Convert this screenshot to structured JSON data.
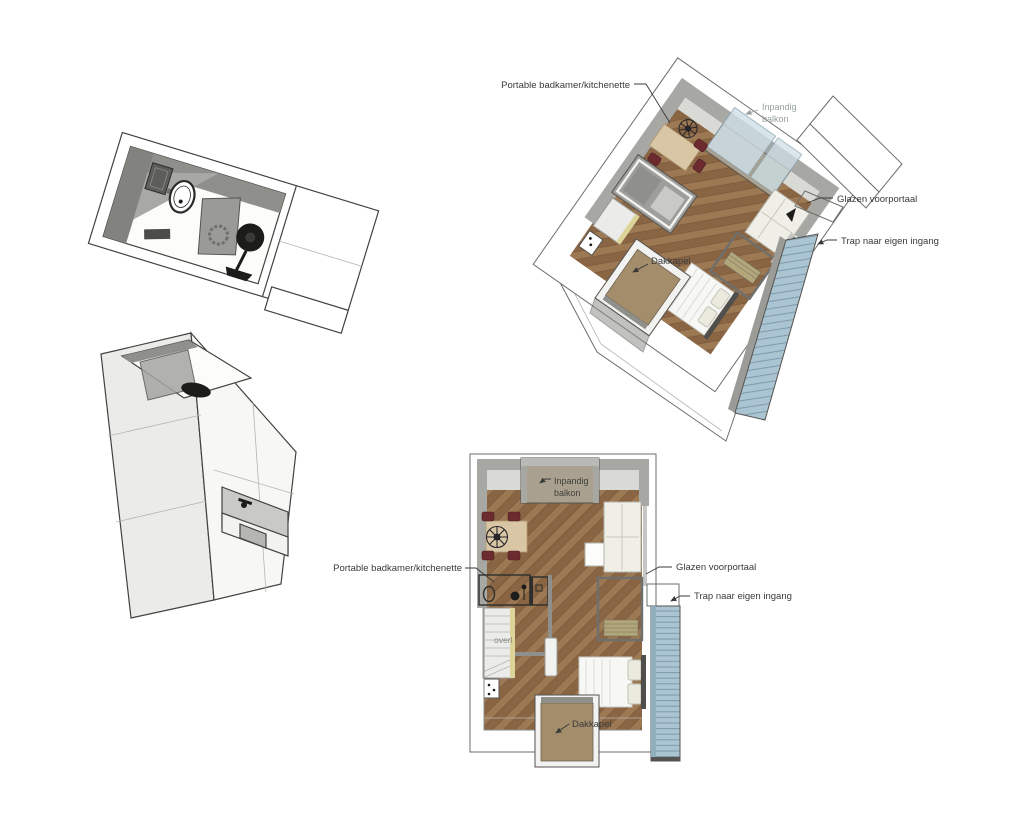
{
  "labels": {
    "axon": {
      "portable": "Portable badkamer/kitchenette",
      "inpandig": [
        "Inpandig",
        "balkon"
      ],
      "dakkapel": "Dakkapel",
      "glazen": "Glazen voorportaal",
      "trap": "Trap naar eigen ingang"
    },
    "top": {
      "inpandig": [
        "Inpandig",
        "balkon"
      ],
      "portable": "Portable badkamer/kitchenette",
      "glazen": "Glazen voorportaal",
      "trap": "Trap naar eigen ingang",
      "dakkapel": "Dakkapel",
      "overloop": "overl"
    }
  },
  "colors": {
    "wood": "#8a6544",
    "wood_light": "#9c7853",
    "wood_dark": "#6e4f33",
    "wall": "#a7a7a3",
    "stairs_blue": "#abc4d2",
    "stair_line": "#7795a6",
    "dormer_tan": "#a38d6b",
    "balcony_tan": "#a9a08f",
    "glass": "#cfe0e8",
    "chair_maroon": "#6d2b30",
    "table_wood": "#d9c6a5",
    "stair_wall_cream": "#ddd49a",
    "label_text": "#3a3a3a",
    "muted_text": "#97a0a0"
  }
}
